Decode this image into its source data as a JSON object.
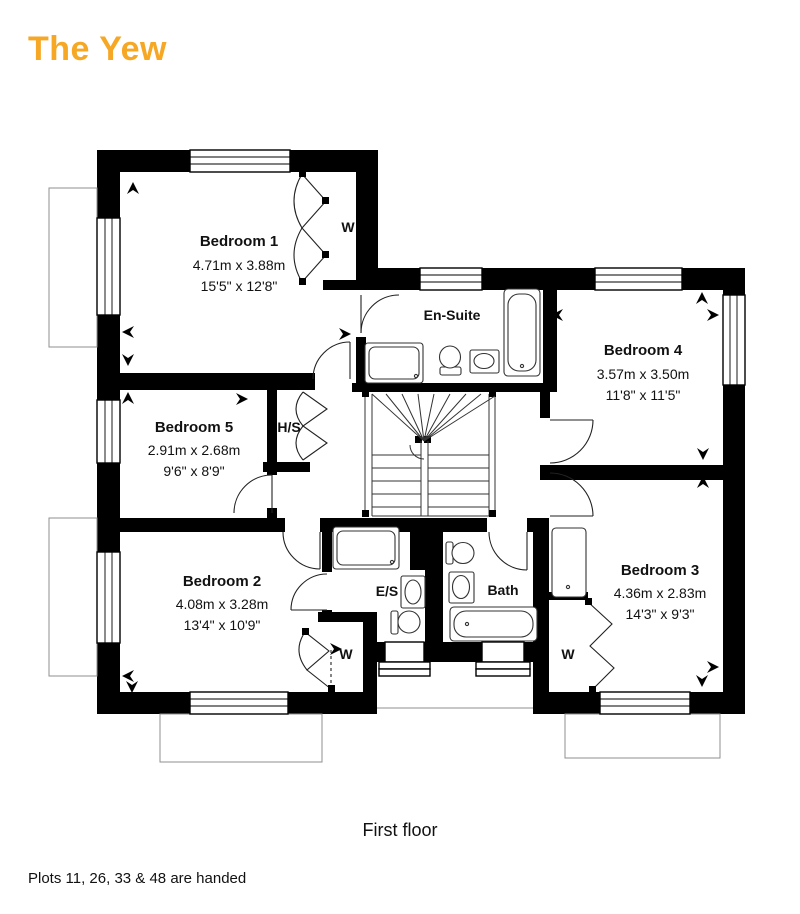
{
  "title": {
    "text": "The Yew",
    "color": "#F6A724"
  },
  "caption": "First floor",
  "footnote": "Plots 11, 26, 33 & 48 are handed",
  "rooms": [
    {
      "name": "Bedroom 1",
      "metric": "4.71m x 3.88m",
      "imperial": "15'5\" x 12'8\""
    },
    {
      "name": "Bedroom 5",
      "metric": "2.91m x 2.68m",
      "imperial": "9'6\" x 8'9\""
    },
    {
      "name": "Bedroom 2",
      "metric": "4.08m x 3.28m",
      "imperial": "13'4\" x 10'9\""
    },
    {
      "name": "Bedroom 4",
      "metric": "3.57m x 3.50m",
      "imperial": "11'8\" x 11'5\""
    },
    {
      "name": "Bedroom 3",
      "metric": "4.36m x 2.83m",
      "imperial": "14'3\" x 9'3\""
    },
    {
      "name": "En-Suite"
    },
    {
      "name": "Bath"
    },
    {
      "name": "E/S"
    },
    {
      "name": "H/S"
    }
  ],
  "closets": {
    "w1": "W",
    "w2": "W",
    "w3": "W"
  }
}
